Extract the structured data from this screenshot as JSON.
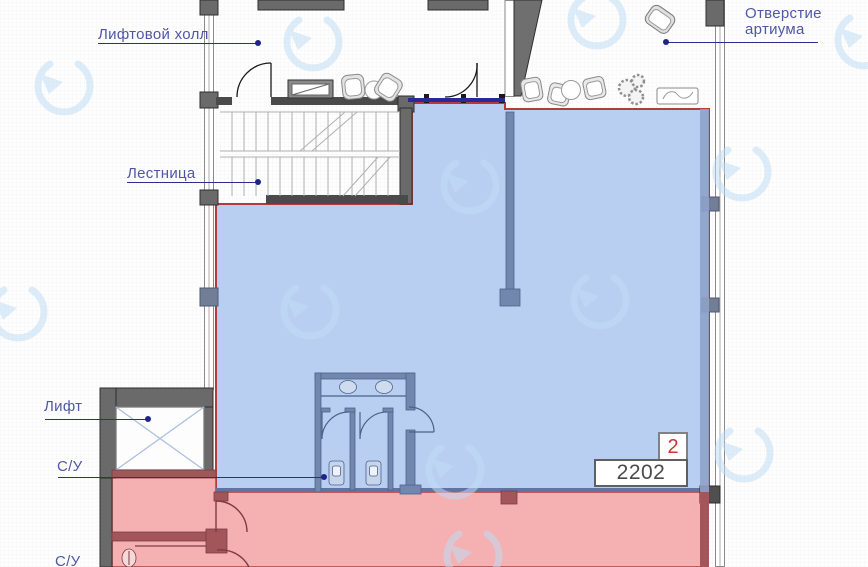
{
  "labels": {
    "lift_hall": "Лифтовой холл",
    "atrium_line1": "Отверстие",
    "atrium_line2": "артиума",
    "stairs": "Лестница",
    "lift": "Лифт",
    "wc_upper": "С/У",
    "wc_lower": "С/У"
  },
  "unit": {
    "floor_badge": "2",
    "number": "2202"
  },
  "colors": {
    "unit_highlight_blue": "#b9cff2",
    "neighbor_highlight_red": "#f5b0b2",
    "unit_outline_red": "#b23c3c",
    "interior_wall_blue": "#7287ad",
    "interior_wall_red": "#a25659",
    "building_wall_gray": "#6a6a6a",
    "label_text": "#4d57a5",
    "leader_line": "#2b2e8c",
    "badge_text_red": "#cc3333",
    "watermark_blue": "#bfdcf4"
  }
}
